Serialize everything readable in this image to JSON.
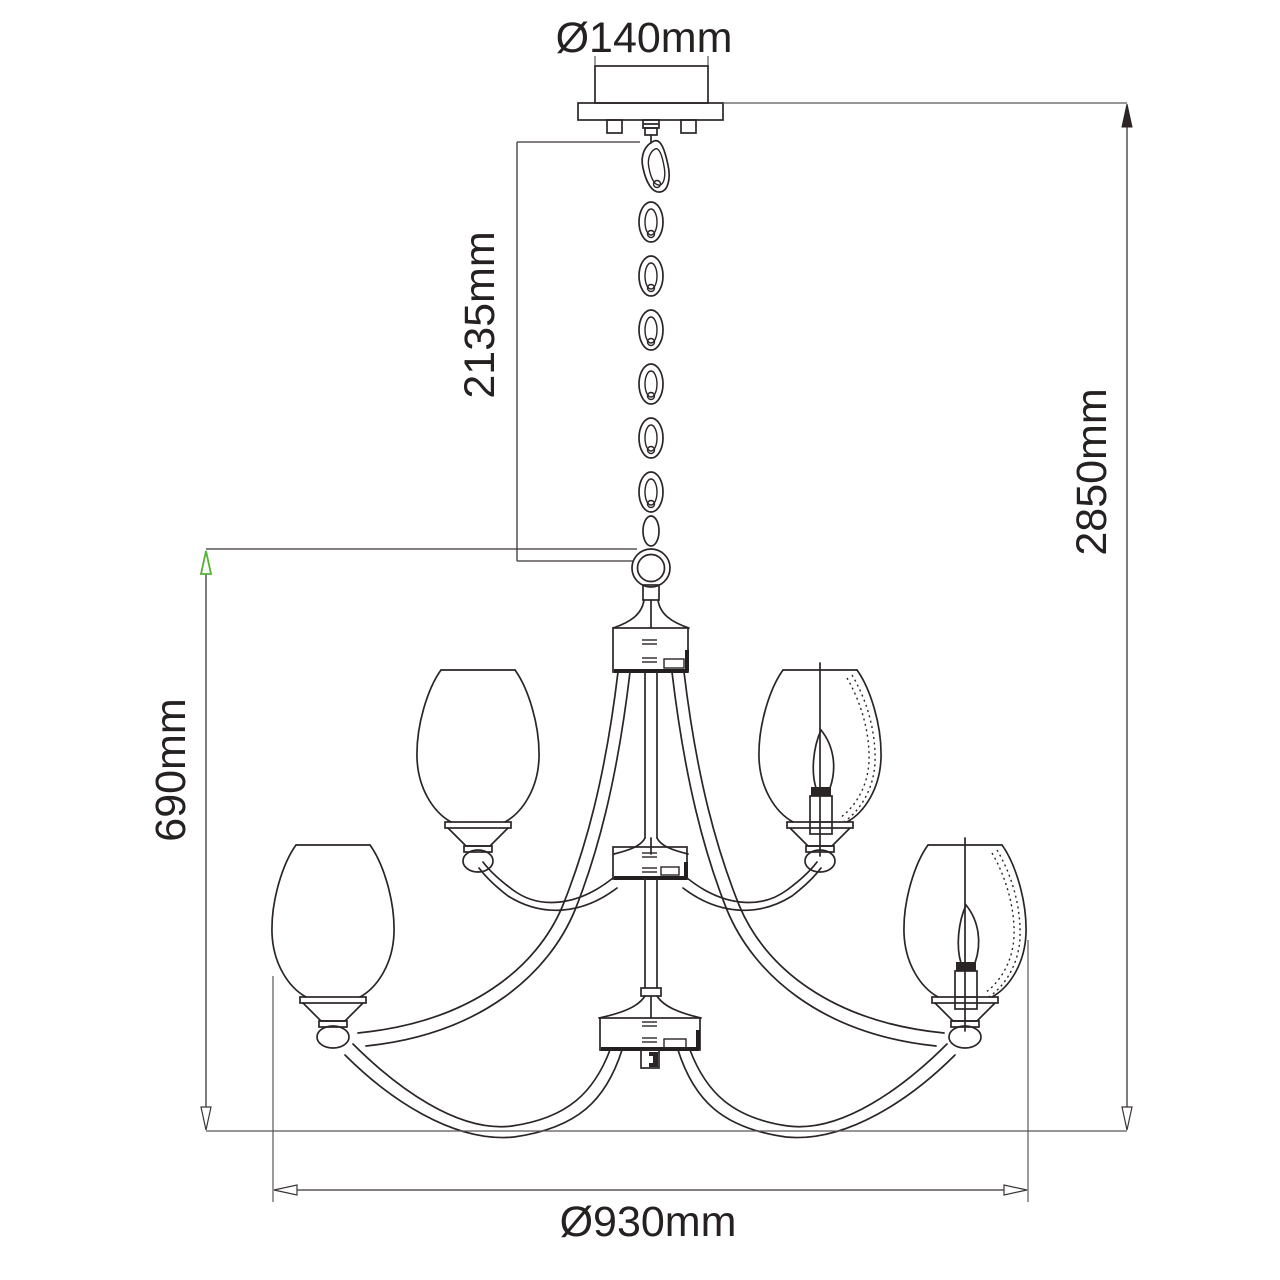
{
  "diagram": {
    "type": "technical-dimension-drawing",
    "subject": "two-tier chandelier with chain suspension, ceiling canopy and tulip glass shades",
    "dimensions": [
      {
        "id": "canopy_diameter",
        "label": "Ø140mm",
        "orientation": "horizontal",
        "measures": "ceiling canopy diameter"
      },
      {
        "id": "chain_drop",
        "label": "2135mm",
        "orientation": "vertical",
        "measures": "chain suspension length from canopy to body ring"
      },
      {
        "id": "total_height",
        "label": "2850mm",
        "orientation": "vertical",
        "measures": "overall hanging height"
      },
      {
        "id": "body_height",
        "label": "690mm",
        "orientation": "vertical",
        "measures": "chandelier body height"
      },
      {
        "id": "body_diameter",
        "label": "Ø930mm",
        "orientation": "horizontal",
        "measures": "chandelier body diameter"
      }
    ],
    "colors": {
      "line": "#2b2526",
      "dimension_line": "#5b5656",
      "accent_green": "#54b435",
      "background": "#ffffff"
    }
  }
}
